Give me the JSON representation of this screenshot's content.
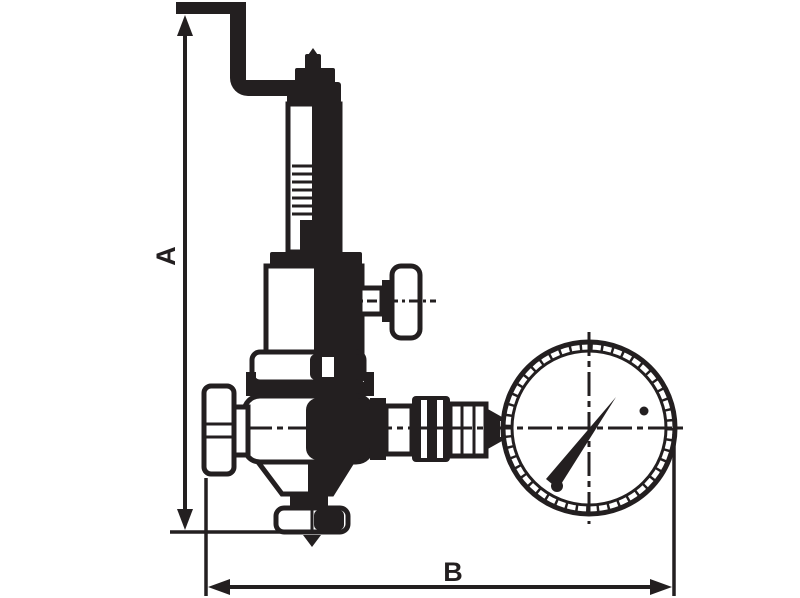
{
  "canvas": {
    "width": 800,
    "height": 598,
    "background_color": "#ffffff",
    "ink_color": "#231f20"
  },
  "drawing": {
    "type": "technical line drawing",
    "subject": "safety relief valve with vent pipe and pressure gauge"
  },
  "dimension_labels": {
    "a": "A",
    "b": "B"
  },
  "parts": {
    "vent_pipe": "vent-pipe",
    "spindle_cap": "spindle-cap",
    "spring_housing": "spring-housing",
    "bonnet": "bonnet",
    "test_handle": "test-handle",
    "body_union_nut": "body-union-nut",
    "valve_body": "valve-body",
    "inlet_union_nut": "inlet-union-nut",
    "bottom_outlet_nut": "bottom-outlet-nut",
    "flow_direction": "flow-down-arrow",
    "outlet_fittings": "outlet-fittings",
    "pressure_gauge": "pressure-gauge",
    "gauge_needle": "gauge-needle"
  }
}
